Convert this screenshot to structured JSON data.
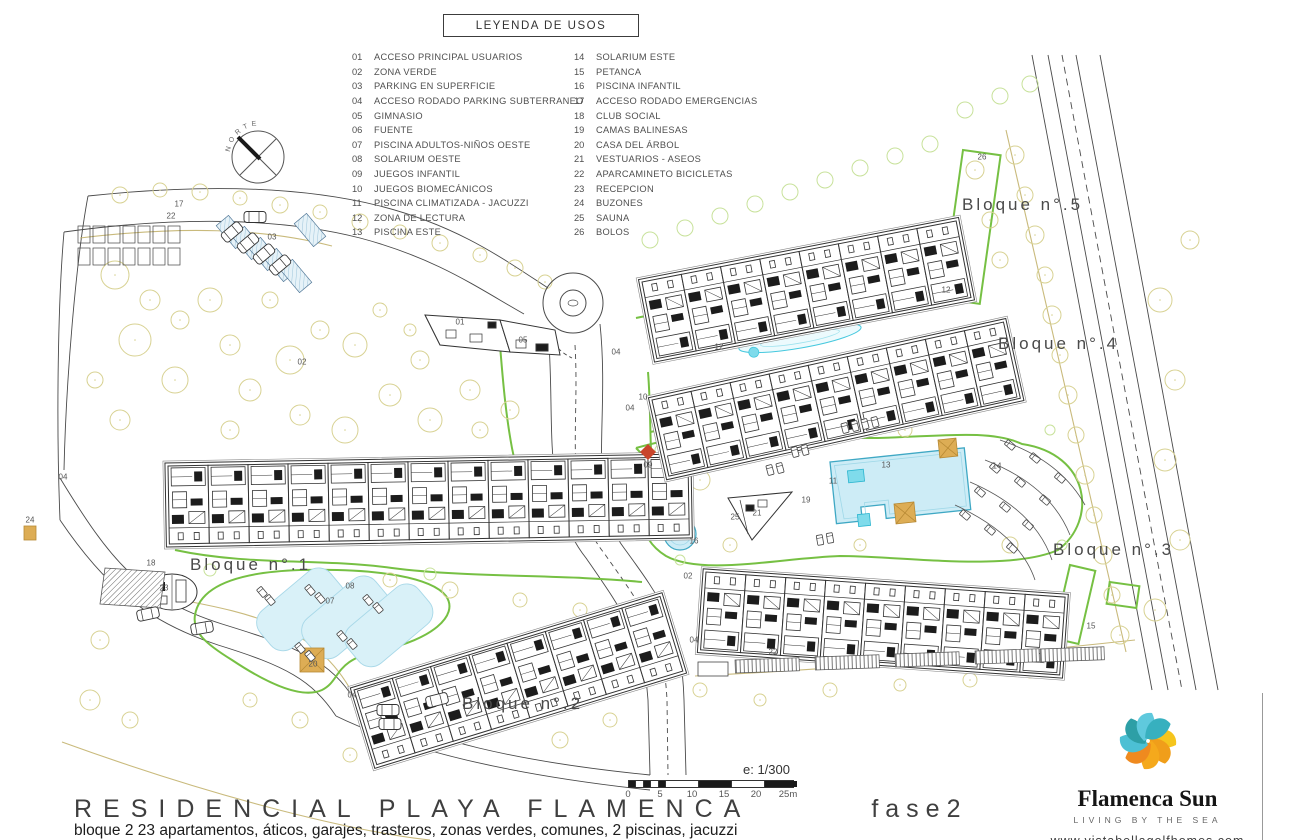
{
  "legend": {
    "title": "LEYENDA DE USOS",
    "columns": [
      [
        {
          "num": "01",
          "label": "ACCESO PRINCIPAL USUARIOS"
        },
        {
          "num": "02",
          "label": "ZONA VERDE"
        },
        {
          "num": "03",
          "label": "PARKING EN SUPERFICIE"
        },
        {
          "num": "04",
          "label": "ACCESO RODADO PARKING SUBTERRANEO"
        },
        {
          "num": "05",
          "label": "GIMNASIO"
        },
        {
          "num": "06",
          "label": "FUENTE"
        },
        {
          "num": "07",
          "label": "PISCINA ADULTOS-NIÑOS OESTE"
        },
        {
          "num": "08",
          "label": "SOLARIUM OESTE"
        },
        {
          "num": "09",
          "label": "JUEGOS INFANTIL"
        },
        {
          "num": "10",
          "label": "JUEGOS BIOMECÁNICOS"
        },
        {
          "num": "11",
          "label": "PISCINA CLIMATIZADA - JACUZZI"
        },
        {
          "num": "12",
          "label": "ZONA DE LECTURA"
        },
        {
          "num": "13",
          "label": "PISCINA ESTE"
        }
      ],
      [
        {
          "num": "14",
          "label": "SOLARIUM ESTE"
        },
        {
          "num": "15",
          "label": "PETANCA"
        },
        {
          "num": "16",
          "label": "PISCINA INFANTIL"
        },
        {
          "num": "17",
          "label": "ACCESO RODADO EMERGENCIAS"
        },
        {
          "num": "18",
          "label": "CLUB SOCIAL"
        },
        {
          "num": "19",
          "label": "CAMAS BALINESAS"
        },
        {
          "num": "20",
          "label": "CASA DEL ÁRBOL"
        },
        {
          "num": "21",
          "label": "VESTUARIOS - ASEOS"
        },
        {
          "num": "22",
          "label": "APARCAMINETO BICICLETAS"
        },
        {
          "num": "23",
          "label": "RECEPCION"
        },
        {
          "num": "24",
          "label": "BUZONES"
        },
        {
          "num": "25",
          "label": "SAUNA"
        },
        {
          "num": "26",
          "label": "BOLOS"
        }
      ]
    ]
  },
  "blocks": [
    {
      "label": "Bloque n°.1"
    },
    {
      "label": "Bloque n°.2"
    },
    {
      "label": "Bloque n°.3"
    },
    {
      "label": "Bloque n°.4"
    },
    {
      "label": "Bloque n°.5"
    }
  ],
  "markers": [
    {
      "num": "17",
      "x": 179,
      "y": 204
    },
    {
      "num": "22",
      "x": 171,
      "y": 216
    },
    {
      "num": "03",
      "x": 272,
      "y": 237
    },
    {
      "num": "01",
      "x": 460,
      "y": 322
    },
    {
      "num": "05",
      "x": 523,
      "y": 340
    },
    {
      "num": "04",
      "x": 63,
      "y": 477
    },
    {
      "num": "04",
      "x": 616,
      "y": 352
    },
    {
      "num": "04",
      "x": 630,
      "y": 408
    },
    {
      "num": "04",
      "x": 352,
      "y": 695
    },
    {
      "num": "04",
      "x": 694,
      "y": 640
    },
    {
      "num": "02",
      "x": 302,
      "y": 362
    },
    {
      "num": "02",
      "x": 688,
      "y": 576
    },
    {
      "num": "09",
      "x": 648,
      "y": 465
    },
    {
      "num": "10",
      "x": 643,
      "y": 397
    },
    {
      "num": "12",
      "x": 719,
      "y": 347
    },
    {
      "num": "12",
      "x": 946,
      "y": 290
    },
    {
      "num": "11",
      "x": 833,
      "y": 481
    },
    {
      "num": "13",
      "x": 886,
      "y": 465
    },
    {
      "num": "14",
      "x": 997,
      "y": 466
    },
    {
      "num": "16",
      "x": 694,
      "y": 541
    },
    {
      "num": "19",
      "x": 806,
      "y": 500
    },
    {
      "num": "21",
      "x": 757,
      "y": 513
    },
    {
      "num": "25",
      "x": 735,
      "y": 517
    },
    {
      "num": "15",
      "x": 1091,
      "y": 626
    },
    {
      "num": "26",
      "x": 982,
      "y": 157
    },
    {
      "num": "18",
      "x": 151,
      "y": 563
    },
    {
      "num": "23",
      "x": 164,
      "y": 588
    },
    {
      "num": "07",
      "x": 330,
      "y": 601
    },
    {
      "num": "08",
      "x": 350,
      "y": 586
    },
    {
      "num": "20",
      "x": 313,
      "y": 664
    },
    {
      "num": "22",
      "x": 773,
      "y": 652
    },
    {
      "num": "24",
      "x": 30,
      "y": 520
    }
  ],
  "compass": {
    "label": "NORTE"
  },
  "scale": {
    "label": "e: 1/300",
    "ticks": [
      "0",
      "5",
      "10",
      "15",
      "20",
      "25m"
    ]
  },
  "title": {
    "project": "RESIDENCIAL PLAYA FLAMENCA",
    "phase": "fase2",
    "subtitle": "bloque 2   23 apartamentos, áticos, garajes, trasteros, zonas verdes, comunes, 2 piscinas, jacuzzi"
  },
  "logo": {
    "brand": "Flamenca Sun",
    "tagline": "LIVING BY THE SEA",
    "urls": [
      "www.vistabellagolfhomes.com",
      "www.residencialplayaflamenca.com"
    ]
  },
  "colors": {
    "path_green": "#76c043",
    "tree_olive": "#d8d293",
    "tree_green": "#c8e29b",
    "pool_fill": "#cdecf6",
    "pool_stroke": "#3fa8c4",
    "water_bright": "#7fdbeb",
    "accent_tan": "#ddad55",
    "marker_red": "#c9452b",
    "olive_path": "#c9ba7c"
  }
}
